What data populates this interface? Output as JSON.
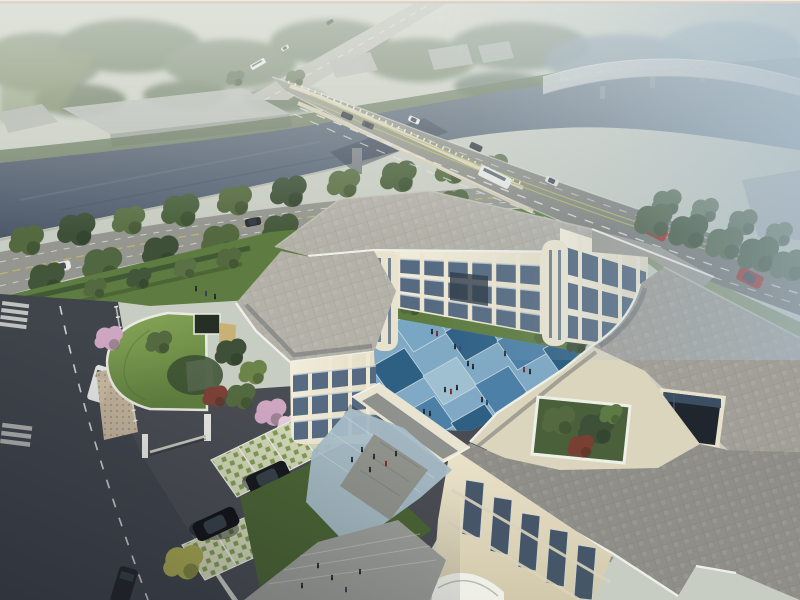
{
  "meta": {
    "description": "Aerial dusk rendering of a three-storey cream courtyard building complex beside a river; an arterial road bridge crosses the river diagonally, a misty elevated ramp curves in the distance, with tree-lined riverside road, blue checkerboard courtyard, roof garden, green-roof gatehouse and grass-grid parking."
  },
  "palette": {
    "sky": "#c8cdc3",
    "mist": "#edf0ea",
    "hazeBlue": "#a9bdcc",
    "river": "#4e5a6b",
    "riverMist": "#8ba2b0",
    "treeDistant": "#76866f",
    "treeDeep": "#3e5138",
    "treeMid": "#54693f",
    "treeLight": "#6d8448",
    "treeHaze": "#6f8279",
    "lawn": "#5e7c41",
    "lawnShade": "#4a6334",
    "hedge": "#3a4d31",
    "blossom": "#cfa6c2",
    "blossomLight": "#e6c9da",
    "redLeaf": "#7c4136",
    "yellowTree": "#a8a851",
    "greenRoof": "#7a9a4e",
    "roadMain": "#8f9189",
    "roadSide": "#94968f",
    "street": "#40444b",
    "asphalt": "#494c52",
    "marking": "#e2e4df",
    "median": "#b4ba5c",
    "creamEdge": "#dad3bc",
    "facade": "#ece6d1",
    "facadeShade": "#d3cbb2",
    "pier": "#efe9d6",
    "glass": "#566b81",
    "glassDark": "#3e5064",
    "frame": "#c3ccd3",
    "roofNorth": "#b3b1a8",
    "roofEast": "#a19f97",
    "roofSouth": "#8f8e88",
    "parapet": "#eef0e8",
    "terrace": "#dcd5bd",
    "courtA": "#4d80a6",
    "courtB": "#2e6084",
    "courtC": "#79a7c3",
    "courtD": "#9fc0d0",
    "plaza": "#a7bcc7",
    "paveGray": "#9b9d98",
    "latticeBase": "#d2d6b6",
    "latticeGreen": "#7f9c55",
    "sand": "#c9b176",
    "warehouse": "#9ba19d",
    "warehouseRoof": "#bcc1bd",
    "carRed": "#a9322c",
    "carDark": "#23272c",
    "carWhite": "#e9ebe8",
    "suvBlack": "#17191d",
    "people": "#232a33"
  },
  "scene": {
    "environment": {
      "river": true,
      "bridge": true,
      "elevated_ramp": true,
      "warehouses": 6,
      "distant_road": true,
      "riverside_road": true
    },
    "campus": {
      "stories": 3,
      "wings": [
        "west",
        "north",
        "northeast",
        "east",
        "south"
      ],
      "courtyard": "blue checkerboard paving",
      "roof_garden": true,
      "atrium_lightwell": true,
      "covered_walkway": true,
      "green_roof_gatehouse": true,
      "grass_grid_parking": true,
      "parked_suvs": 2
    },
    "vehicles": {
      "bridge_road": {
        "cars": 6,
        "bus": 1,
        "red_suvs": 2
      },
      "riverside_road": {
        "cars": 2
      },
      "street": {
        "van": 1,
        "car": 1
      },
      "distant_road": {
        "bus": 1,
        "cars": 2
      }
    },
    "people_groups": {
      "courtyard": 8,
      "plaza": 2,
      "forecourt": 1,
      "north_lawn": 1
    }
  }
}
